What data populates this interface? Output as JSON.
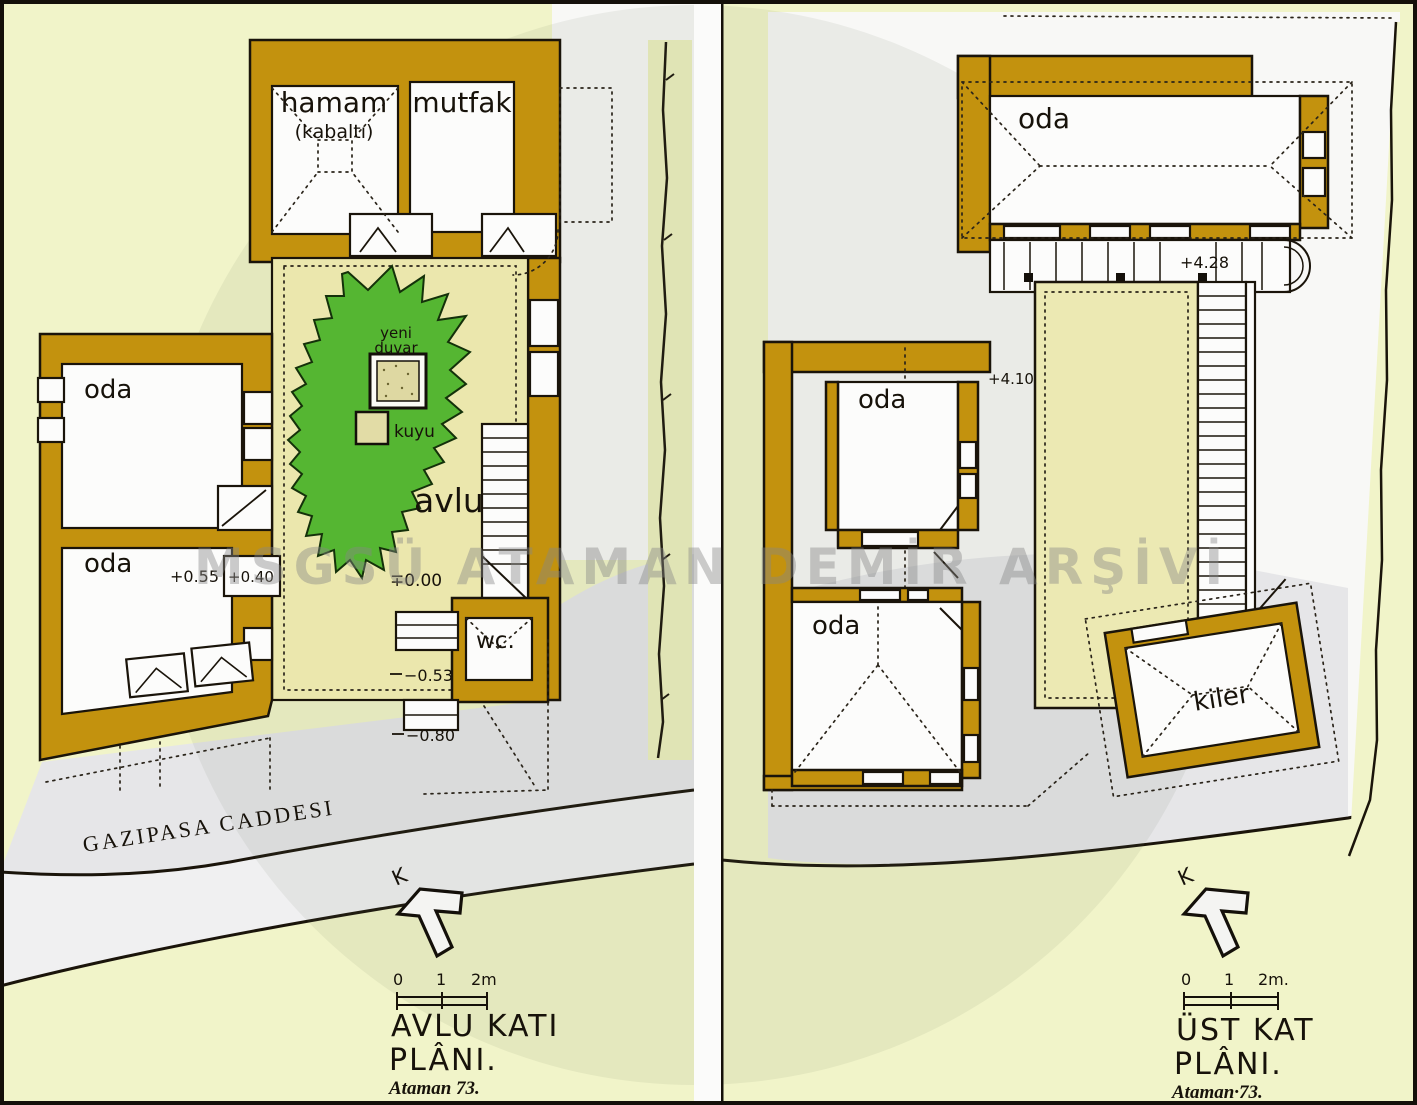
{
  "watermark": {
    "text": "MSGSÜ ATAMAN DEMİR ARŞİVİ"
  },
  "left_plan": {
    "street_label": "GAZIPASA CADDESI",
    "north_label": "K",
    "scale": {
      "n0": "0",
      "n1": "1",
      "n2": "2m"
    },
    "title": {
      "line1": "AVLU KATI",
      "line2": "PLÂNI.",
      "signature": "Ataman 73."
    },
    "labels": {
      "hamam": "hamam",
      "hamam_note": "(kabaltı)",
      "mutfak": "mutfak",
      "oda_upper": "oda",
      "oda_lower": "oda",
      "avlu": "avlu",
      "yeni_line1": "yeni",
      "yeni_line2": "duvar",
      "kuyu": "kuyu",
      "wc": "wc."
    },
    "elevations": {
      "courtyard": "∓0.00",
      "oda_lower": "+0.55",
      "threshold": "+0.40",
      "step1": "−0.53",
      "step2": "−0.80"
    }
  },
  "right_plan": {
    "north_label": "K",
    "scale": {
      "n0": "0",
      "n1": "1",
      "n2": "2m."
    },
    "title": {
      "line1": "ÜST KAT",
      "line2": "PLÂNI.",
      "signature": "Ataman·73."
    },
    "labels": {
      "oda_top": "oda",
      "oda_middle": "oda",
      "oda_lower": "oda",
      "kiler": "kiler"
    },
    "elevations": {
      "gallery": "+4.28",
      "landing": "+4.10"
    }
  }
}
